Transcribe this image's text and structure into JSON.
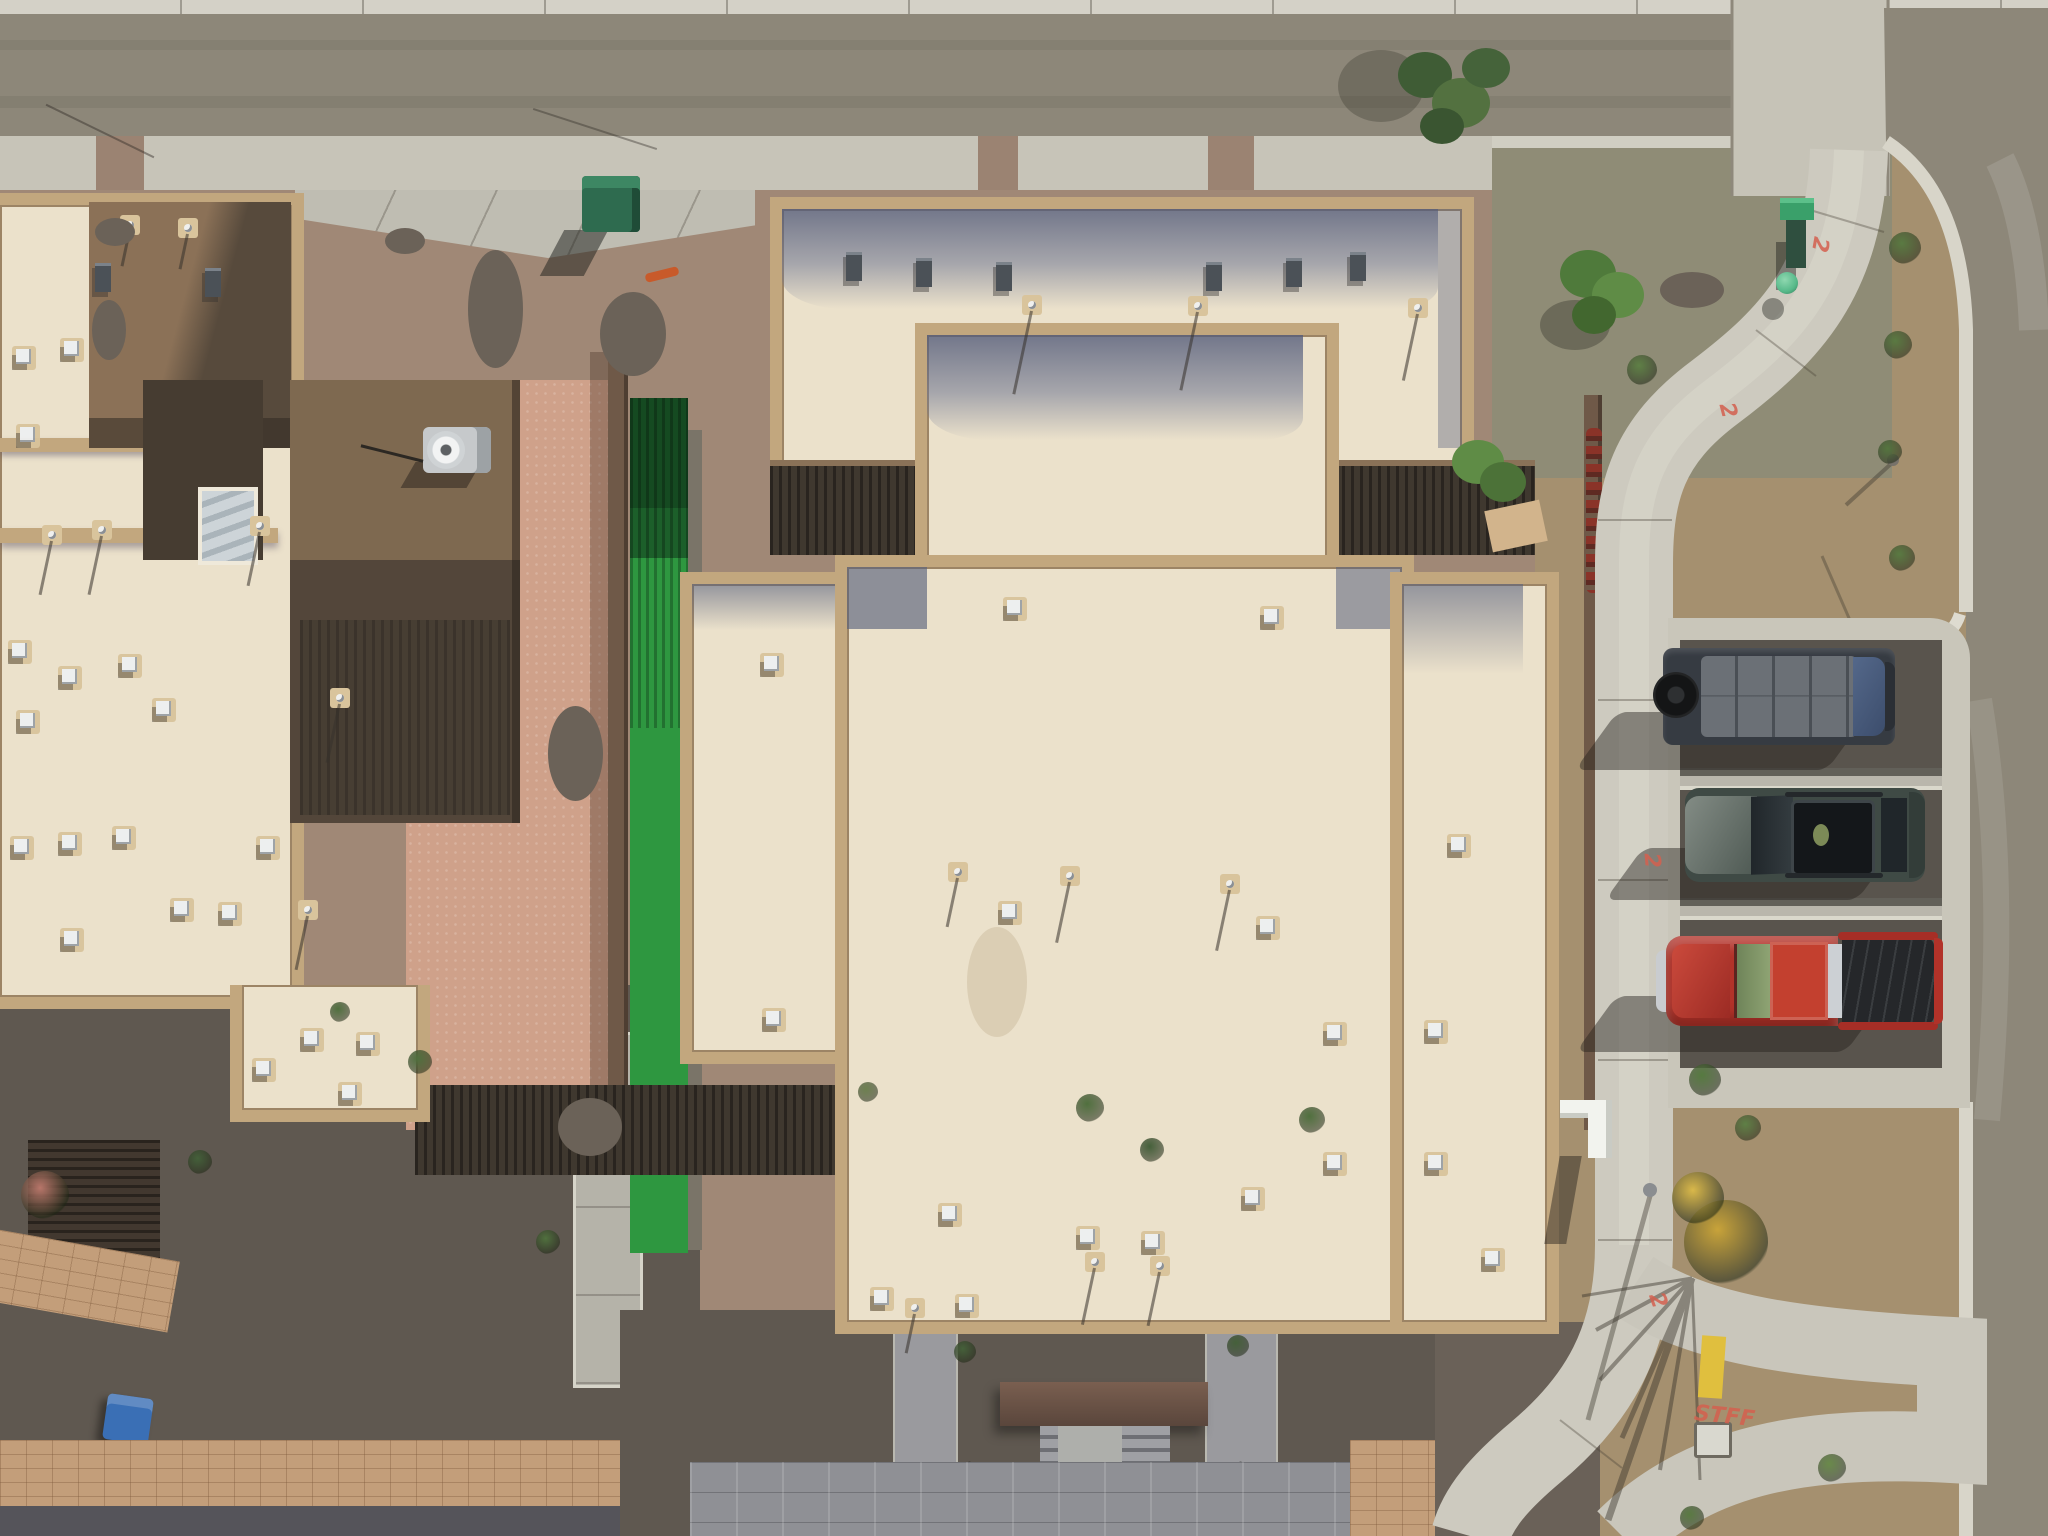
{
  "scene": {
    "type": "aerial-drone-photograph",
    "description": "Top-down aerial drone view of desert townhome buildings with flat cream roofs and tan parapets, gravel xeriscape yards, artificial turf strip, shaded courtyards, a curving concrete sidewalk at a street corner, and three vehicles parked in head-in stalls beside the road",
    "time_of_day": "midday, hard sun from upper right",
    "palette": {
      "asphalt_road": "#8d8779",
      "concrete_sidewalk": "#c7c4b8",
      "gravel_pink": "#a08876",
      "gravel_tan": "#a5906f",
      "gravel_gray_green": "#8f8c76",
      "roof_cream": "#ebe1cb",
      "parapet_tan": "#c2a77e",
      "roof_shadow_blue": "#8f95a8",
      "wall_brown": "#8b7157",
      "dirt_salmon": "#cfa18a",
      "turf_green": "#2e9740",
      "courtyard_shadow": "#5f5850",
      "paver_tan": "#c39e7a",
      "utility_green": "#35815d",
      "van_gray": "#3a3f46",
      "suv_gray_green": "#414b46",
      "truck_red": "#b23229",
      "curb_yellow": "#e0bf3e",
      "spray_red": "#d4604f"
    }
  },
  "markings": [
    {
      "text": "2",
      "x": 1812,
      "y": 232,
      "rot": 100
    },
    {
      "text": "2",
      "x": 1720,
      "y": 398,
      "rot": 75
    },
    {
      "text": "2",
      "x": 1644,
      "y": 848,
      "rot": 85
    },
    {
      "text": "2",
      "x": 1650,
      "y": 1288,
      "rot": 70
    },
    {
      "text": "STFF",
      "x": 1694,
      "y": 1404,
      "rot": 6
    }
  ],
  "vehicles": [
    {
      "name": "cargo-van",
      "color": "#3a3f46",
      "detail": "dark gray van, blue windshield at street end, spare tire at rear"
    },
    {
      "name": "suv",
      "color": "#414b46",
      "detail": "dark gray-green SUV with open panoramic roof and roof rails"
    },
    {
      "name": "pickup-truck",
      "color": "#b23229",
      "detail": "red crew-cab pickup with open black bed"
    }
  ],
  "features": {
    "white_vents": [
      {
        "x": 12,
        "y": 346
      },
      {
        "x": 16,
        "y": 424
      },
      {
        "x": 60,
        "y": 338
      },
      {
        "x": 8,
        "y": 640
      },
      {
        "x": 58,
        "y": 666
      },
      {
        "x": 118,
        "y": 654
      },
      {
        "x": 16,
        "y": 710
      },
      {
        "x": 152,
        "y": 698
      },
      {
        "x": 10,
        "y": 836
      },
      {
        "x": 58,
        "y": 832
      },
      {
        "x": 112,
        "y": 826
      },
      {
        "x": 170,
        "y": 898
      },
      {
        "x": 60,
        "y": 928
      },
      {
        "x": 218,
        "y": 902
      },
      {
        "x": 256,
        "y": 836
      },
      {
        "x": 300,
        "y": 1028
      },
      {
        "x": 356,
        "y": 1032
      },
      {
        "x": 252,
        "y": 1058
      },
      {
        "x": 338,
        "y": 1082
      },
      {
        "x": 1003,
        "y": 597
      },
      {
        "x": 1260,
        "y": 606
      },
      {
        "x": 998,
        "y": 901
      },
      {
        "x": 1256,
        "y": 916
      },
      {
        "x": 938,
        "y": 1203
      },
      {
        "x": 1076,
        "y": 1226
      },
      {
        "x": 1141,
        "y": 1231
      },
      {
        "x": 870,
        "y": 1287
      },
      {
        "x": 955,
        "y": 1294
      },
      {
        "x": 1241,
        "y": 1187
      },
      {
        "x": 760,
        "y": 653
      },
      {
        "x": 762,
        "y": 1008
      },
      {
        "x": 1323,
        "y": 1022
      },
      {
        "x": 1424,
        "y": 1020
      },
      {
        "x": 1323,
        "y": 1152
      },
      {
        "x": 1424,
        "y": 1152
      },
      {
        "x": 1447,
        "y": 834
      },
      {
        "x": 1481,
        "y": 1248
      }
    ],
    "dark_vents": [
      {
        "x": 846,
        "y": 252
      },
      {
        "x": 916,
        "y": 258
      },
      {
        "x": 996,
        "y": 262
      },
      {
        "x": 1206,
        "y": 262
      },
      {
        "x": 1286,
        "y": 258
      },
      {
        "x": 1350,
        "y": 252
      },
      {
        "x": 95,
        "y": 263
      },
      {
        "x": 205,
        "y": 268
      }
    ],
    "pipes": [
      {
        "x": 120,
        "y": 215,
        "len": 36
      },
      {
        "x": 178,
        "y": 218,
        "len": 36
      },
      {
        "x": 42,
        "y": 525,
        "len": 55
      },
      {
        "x": 92,
        "y": 520,
        "len": 60
      },
      {
        "x": 250,
        "y": 516,
        "len": 55
      },
      {
        "x": 330,
        "y": 688,
        "len": 60
      },
      {
        "x": 298,
        "y": 900,
        "len": 55
      },
      {
        "x": 1022,
        "y": 295,
        "len": 85
      },
      {
        "x": 1188,
        "y": 296,
        "len": 80
      },
      {
        "x": 1408,
        "y": 298,
        "len": 68
      },
      {
        "x": 1060,
        "y": 866,
        "len": 62
      },
      {
        "x": 1220,
        "y": 874,
        "len": 62
      },
      {
        "x": 948,
        "y": 862,
        "len": 50
      },
      {
        "x": 1085,
        "y": 1252,
        "len": 58
      },
      {
        "x": 1150,
        "y": 1256,
        "len": 55
      },
      {
        "x": 905,
        "y": 1298,
        "len": 40
      }
    ],
    "shrubs": [
      {
        "x": 1905,
        "y": 248,
        "r": 16,
        "c": "#5a7a42"
      },
      {
        "x": 1898,
        "y": 345,
        "r": 14,
        "c": "#5a7a42"
      },
      {
        "x": 1890,
        "y": 452,
        "r": 12,
        "c": "#55753f"
      },
      {
        "x": 1902,
        "y": 558,
        "r": 13,
        "c": "#5a7a42"
      },
      {
        "x": 1642,
        "y": 370,
        "r": 15,
        "c": "#5f8046"
      },
      {
        "x": 1705,
        "y": 1080,
        "r": 16,
        "c": "#567a40"
      },
      {
        "x": 1748,
        "y": 1128,
        "r": 13,
        "c": "#5f8046"
      },
      {
        "x": 1832,
        "y": 1468,
        "r": 14,
        "c": "#6a8a4a"
      },
      {
        "x": 1692,
        "y": 1518,
        "r": 12,
        "c": "#5a7a42"
      },
      {
        "x": 1090,
        "y": 1108,
        "r": 14,
        "c": "#50703e"
      },
      {
        "x": 1152,
        "y": 1150,
        "r": 12,
        "c": "#45603a"
      },
      {
        "x": 1312,
        "y": 1120,
        "r": 13,
        "c": "#50703e"
      },
      {
        "x": 868,
        "y": 1092,
        "r": 10,
        "c": "#6d8050"
      },
      {
        "x": 420,
        "y": 1062,
        "r": 12,
        "c": "#50703e"
      },
      {
        "x": 200,
        "y": 1162,
        "r": 12,
        "c": "#44603a"
      },
      {
        "x": 548,
        "y": 1242,
        "r": 12,
        "c": "#50703e"
      },
      {
        "x": 965,
        "y": 1352,
        "r": 11,
        "c": "#45603a"
      },
      {
        "x": 1238,
        "y": 1346,
        "r": 11,
        "c": "#45603a"
      },
      {
        "x": 45,
        "y": 1195,
        "r": 24,
        "c": "#b8766a"
      },
      {
        "x": 1726,
        "y": 1242,
        "r": 42,
        "c": "#c8a33a"
      },
      {
        "x": 1698,
        "y": 1198,
        "r": 26,
        "c": "#d9b84a"
      },
      {
        "x": 340,
        "y": 1012,
        "r": 10,
        "c": "#50703e"
      }
    ],
    "rocks": [
      {
        "x": 468,
        "y": 250,
        "w": 55,
        "h": 118
      },
      {
        "x": 600,
        "y": 292,
        "w": 66,
        "h": 84
      },
      {
        "x": 1660,
        "y": 272,
        "w": 64,
        "h": 36
      },
      {
        "x": 548,
        "y": 706,
        "w": 55,
        "h": 95
      },
      {
        "x": 558,
        "y": 1098,
        "w": 64,
        "h": 58
      },
      {
        "x": 95,
        "y": 218,
        "w": 40,
        "h": 28
      },
      {
        "x": 385,
        "y": 228,
        "w": 40,
        "h": 26
      },
      {
        "x": 92,
        "y": 300,
        "w": 34,
        "h": 60
      }
    ]
  }
}
